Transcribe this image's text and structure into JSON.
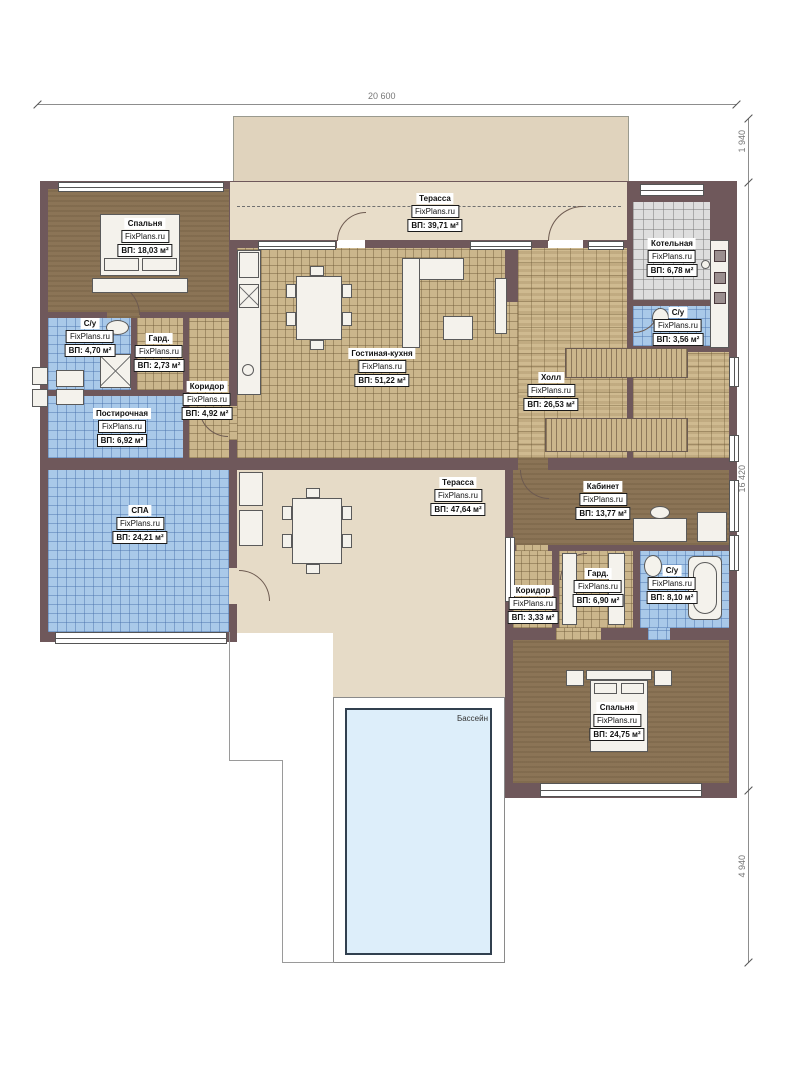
{
  "brand": "FixPlans.ru",
  "dimensions": {
    "top": "20 600",
    "right_top": "1 940",
    "right_middle": "16 420",
    "right_bottom": "4 940"
  },
  "rooms": [
    {
      "name": "Спальня",
      "brand": "FixPlans.ru",
      "area": "ВП: 18,03 м²"
    },
    {
      "name": "Терасса",
      "brand": "FixPlans.ru",
      "area": "ВП: 39,71 м²"
    },
    {
      "name": "Котельная",
      "brand": "FixPlans.ru",
      "area": "ВП: 6,78 м²"
    },
    {
      "name": "С/у",
      "brand": "FixPlans.ru",
      "area": "ВП: 3,56 м²"
    },
    {
      "name": "С/у",
      "brand": "FixPlans.ru",
      "area": "ВП: 4,70 м²"
    },
    {
      "name": "Гард.",
      "brand": "FixPlans.ru",
      "area": "ВП: 2,73 м²"
    },
    {
      "name": "Коридор",
      "brand": "FixPlans.ru",
      "area": "ВП: 4,92 м²"
    },
    {
      "name": "Гостиная-кухня",
      "brand": "FixPlans.ru",
      "area": "ВП: 51,22 м²"
    },
    {
      "name": "Холл",
      "brand": "FixPlans.ru",
      "area": "ВП: 26,53 м²"
    },
    {
      "name": "Постирочная",
      "brand": "FixPlans.ru",
      "area": "ВП: 6,92 м²"
    },
    {
      "name": "СПА",
      "brand": "FixPlans.ru",
      "area": "ВП: 24,21 м²"
    },
    {
      "name": "Терасса",
      "brand": "FixPlans.ru",
      "area": "ВП: 47,64 м²"
    },
    {
      "name": "Кабинет",
      "brand": "FixPlans.ru",
      "area": "ВП: 13,77 м²"
    },
    {
      "name": "Гард.",
      "brand": "FixPlans.ru",
      "area": "ВП: 6,90 м²"
    },
    {
      "name": "С/у",
      "brand": "FixPlans.ru",
      "area": "ВП: 8,10 м²"
    },
    {
      "name": "Коридор",
      "brand": "FixPlans.ru",
      "area": "ВП: 3,33 м²"
    },
    {
      "name": "Спальня",
      "brand": "FixPlans.ru",
      "area": "ВП: 24,75 м²"
    }
  ],
  "pool": {
    "label": "Бассейн"
  },
  "colors": {
    "wall": "#6f585b",
    "tile_tan": "#cbb68c",
    "tile_blue": "#a9c9e9",
    "tile_gray": "#dedede",
    "carpet_brown": "#8b7456",
    "terrace_beige": "#e6dbc7",
    "pool_water": "#ddeefa"
  }
}
